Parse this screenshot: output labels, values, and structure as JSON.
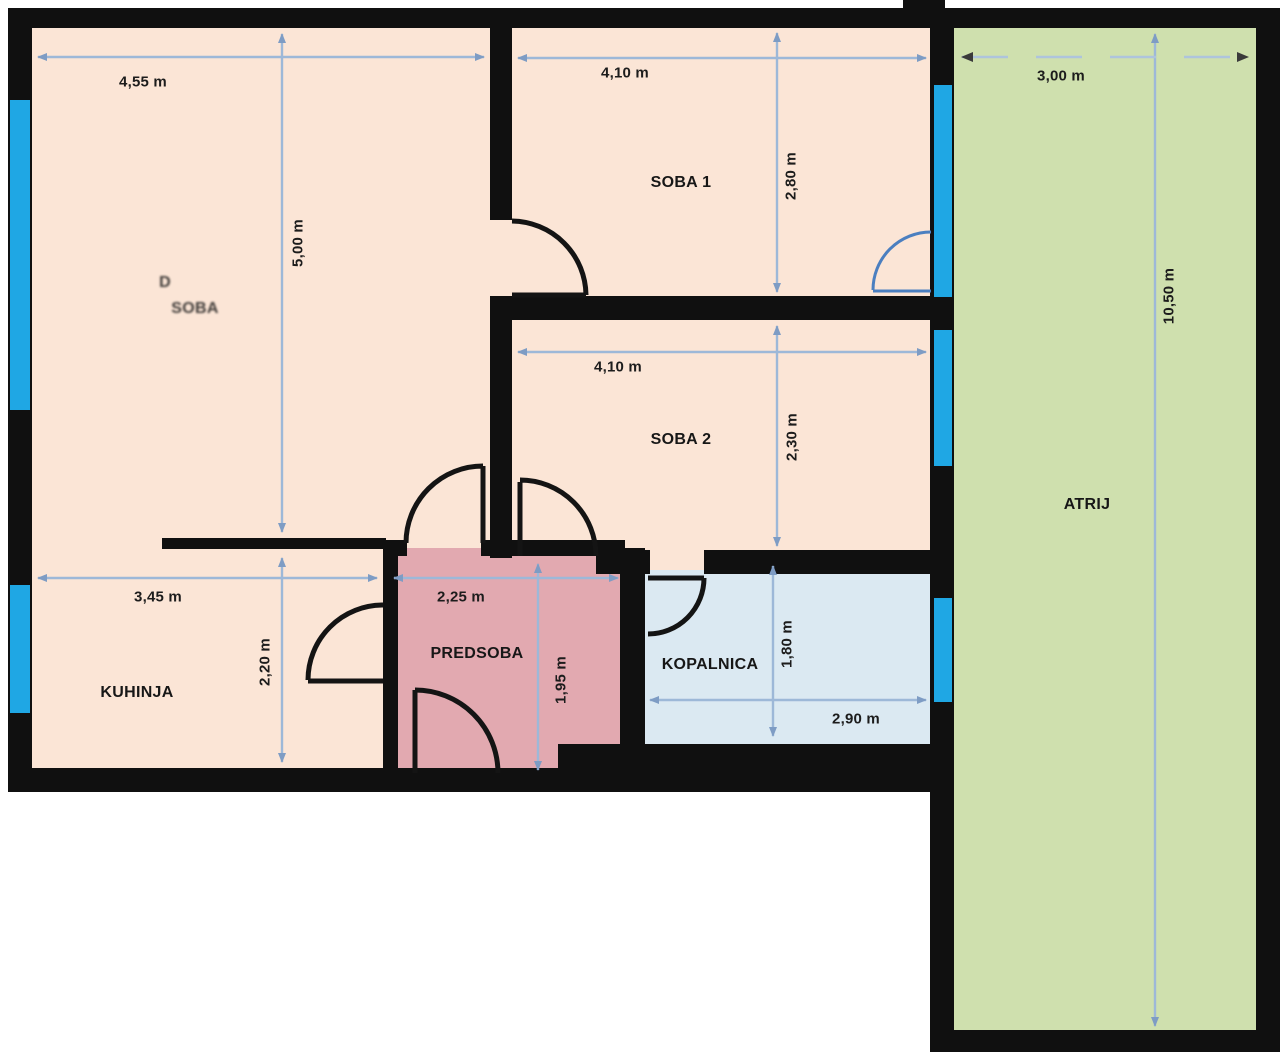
{
  "title": "Floor plan with room dimensions",
  "rooms": {
    "living": {
      "partial_top": "D",
      "partial_bottom": "SOBA"
    },
    "soba1": {
      "label": "SOBA 1"
    },
    "soba2": {
      "label": "SOBA 2"
    },
    "kuhinja": {
      "label": "KUHINJA"
    },
    "predsoba": {
      "label": "PREDSOBA"
    },
    "kopalnica": {
      "label": "KOPALNICA"
    },
    "atrij": {
      "label": "ATRIJ"
    }
  },
  "dims": {
    "living_w": "4,55 m",
    "living_h": "5,00 m",
    "soba1_w": "4,10 m",
    "soba1_h": "2,80 m",
    "soba2_w": "4,10 m",
    "soba2_h": "2,30 m",
    "kuhinja_w": "3,45 m",
    "kuhinja_h": "2,20 m",
    "predsoba_w": "2,25 m",
    "predsoba_h": "1,95 m",
    "kopalnica_w": "2,90 m",
    "kopalnica_h": "1,80 m",
    "atrij_w": "3,00 m",
    "atrij_h": "10,50 m"
  },
  "colors": {
    "wall": "#101010",
    "room_fill": "#fbe5d6",
    "predsoba_fill": "#e2a9b0",
    "kopalnica_fill": "#dbe9f2",
    "atrij_fill": "#cfe0ae",
    "window": "#1fa7e4",
    "dim_line": "#9db8d8",
    "dim_arrow": "#7e9cc4",
    "balcony_door": "#4b7fc0",
    "label_text": "#1c1c1c"
  }
}
